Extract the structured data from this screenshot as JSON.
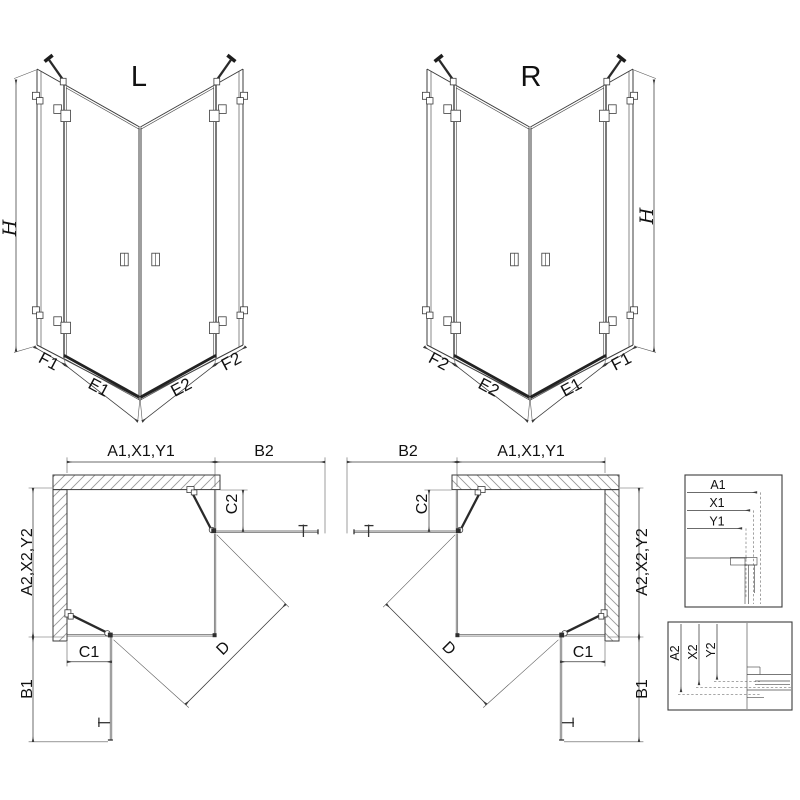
{
  "colors": {
    "ink": "#3c3c3c",
    "ink_dark": "#1d1d1d",
    "hatch": "#9a9a9a",
    "background": "#ffffff"
  },
  "iso_views": {
    "left": {
      "variant_label": "L",
      "height_label": "H",
      "left_fixed_label": "F1",
      "left_door_label": "E1",
      "right_door_label": "E2",
      "right_fixed_label": "F2"
    },
    "right": {
      "variant_label": "R",
      "height_label": "H",
      "left_fixed_label": "F2",
      "left_door_label": "E2",
      "right_door_label": "E1",
      "right_fixed_label": "F1"
    }
  },
  "plan_views": {
    "left": {
      "width_label": "A1,X1,Y1",
      "door_open_width_label": "B2",
      "side_fixed_label": "C2",
      "depth_label": "A2,X2,Y2",
      "bottom_fixed_label": "C1",
      "door_open_depth_label": "B1",
      "diagonal_label": "D"
    },
    "right": {
      "width_label": "A1,X1,Y1",
      "door_open_width_label": "B2",
      "side_fixed_label": "C2",
      "depth_label": "A2,X2,Y2",
      "bottom_fixed_label": "C1",
      "door_open_depth_label": "B1",
      "diagonal_label": "D"
    }
  },
  "detail_boxes": {
    "width_section": {
      "labels": [
        "A1",
        "X1",
        "Y1"
      ]
    },
    "depth_section": {
      "labels": [
        "A2",
        "X2",
        "Y2"
      ]
    }
  }
}
